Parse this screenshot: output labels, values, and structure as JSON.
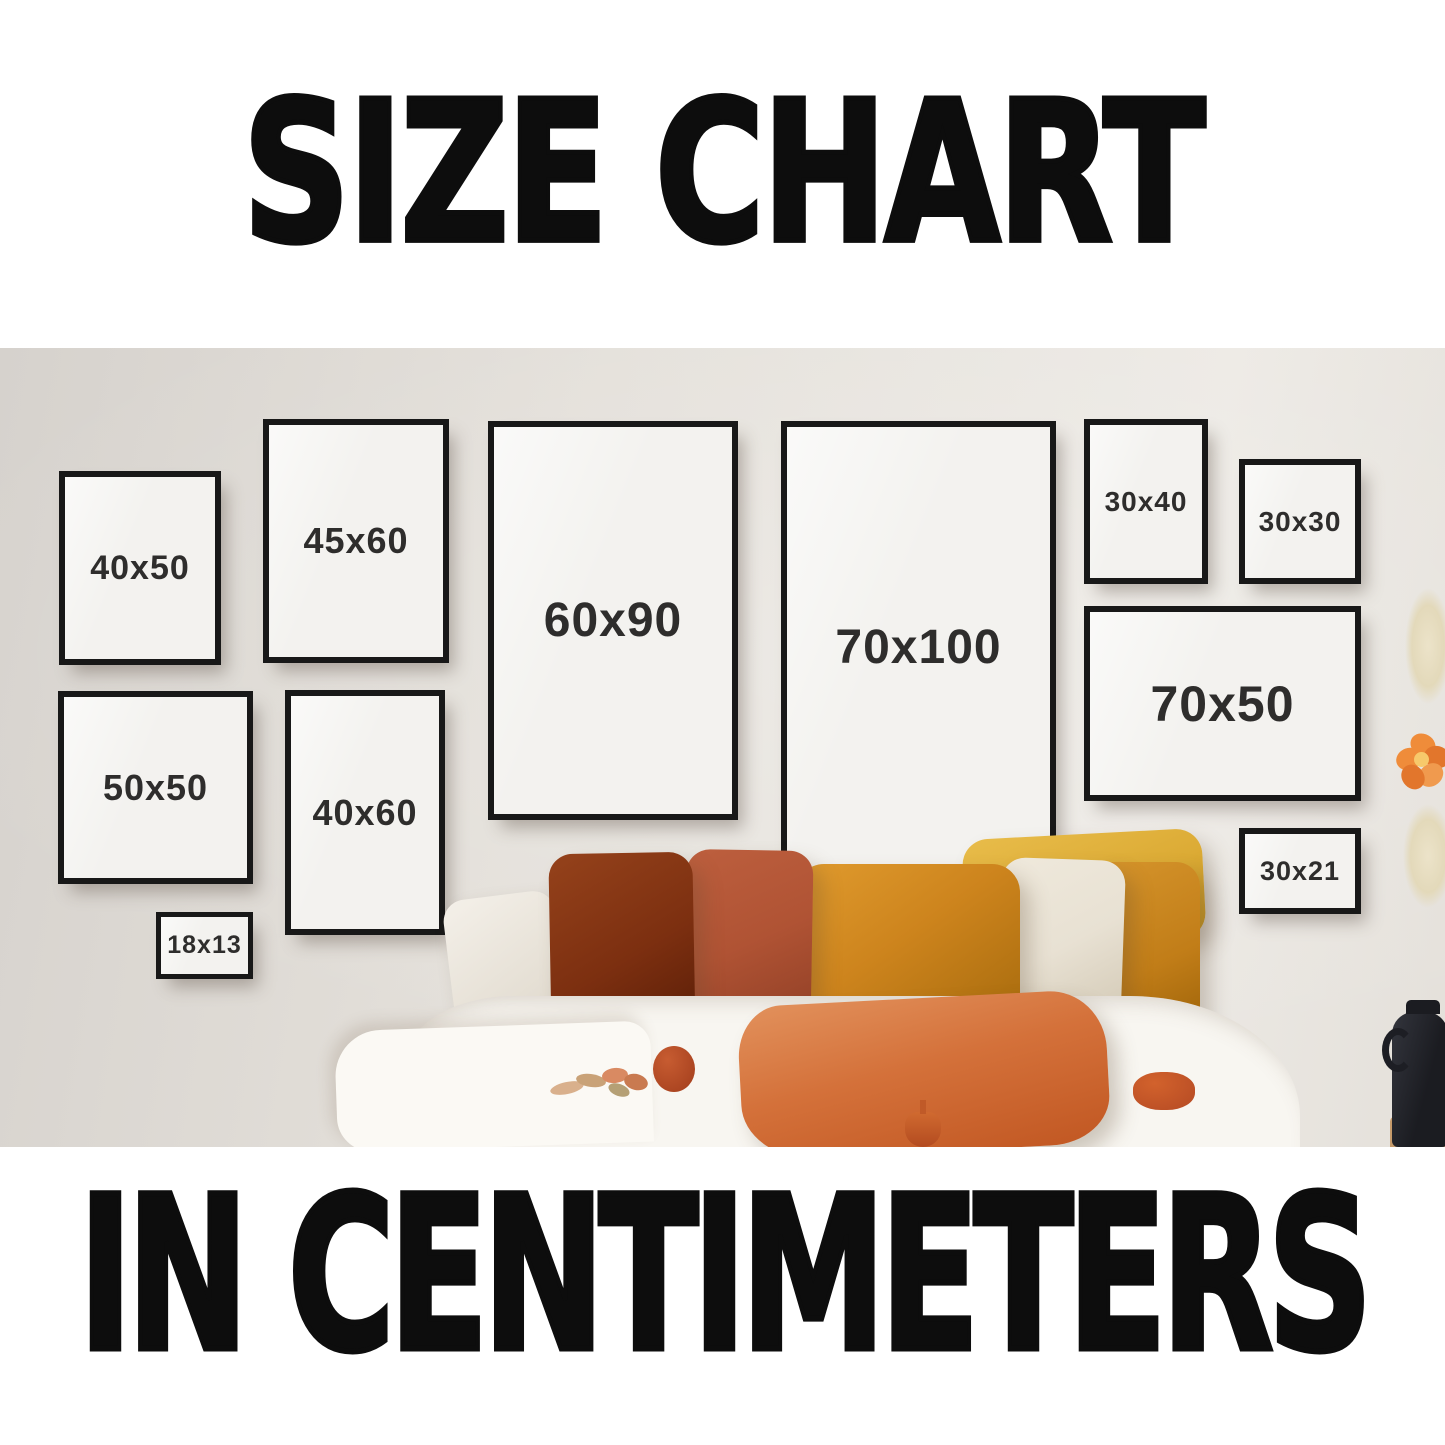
{
  "header": {
    "title": "SIZE CHART"
  },
  "footer": {
    "title": "IN CENTIMETERS"
  },
  "scene": {
    "frames": [
      {
        "id": "40x50",
        "label": "40x50"
      },
      {
        "id": "45x60",
        "label": "45x60"
      },
      {
        "id": "60x90",
        "label": "60x90"
      },
      {
        "id": "70x100",
        "label": "70x100"
      },
      {
        "id": "30x40",
        "label": "30x40"
      },
      {
        "id": "30x30",
        "label": "30x30"
      },
      {
        "id": "70x50",
        "label": "70x50"
      },
      {
        "id": "50x50",
        "label": "50x50"
      },
      {
        "id": "40x60",
        "label": "40x60"
      },
      {
        "id": "18x13",
        "label": "18x13"
      },
      {
        "id": "30x21",
        "label": "30x21"
      }
    ]
  },
  "palette": {
    "page_bg": "#ffffff",
    "title_color": "#0d0d0d",
    "wall": "#e4e0da",
    "wall_dark": "#d6d2cd",
    "wall_light": "#edeae5",
    "frame_border": "#181818",
    "frame_face": "#f3f2ef",
    "label_color": "#2e2d2c",
    "pillow_white": "#efeae1",
    "pillow_dark_rust": "#7c2f10",
    "pillow_terracotta": "#b05334",
    "pillow_amber": "#cd841d",
    "pillow_cream": "#e8e1d3",
    "pillow_yellow": "#dcab35",
    "pillow_mustard": "#c17d18",
    "pillow_front_orange": "#d4713a",
    "tassel": "#b54a24",
    "bed_white": "#f8f6f1",
    "vase_dark": "#23252b",
    "vase_base_tan": "#c69b6b",
    "flower_orange": "#ef8c3a"
  }
}
